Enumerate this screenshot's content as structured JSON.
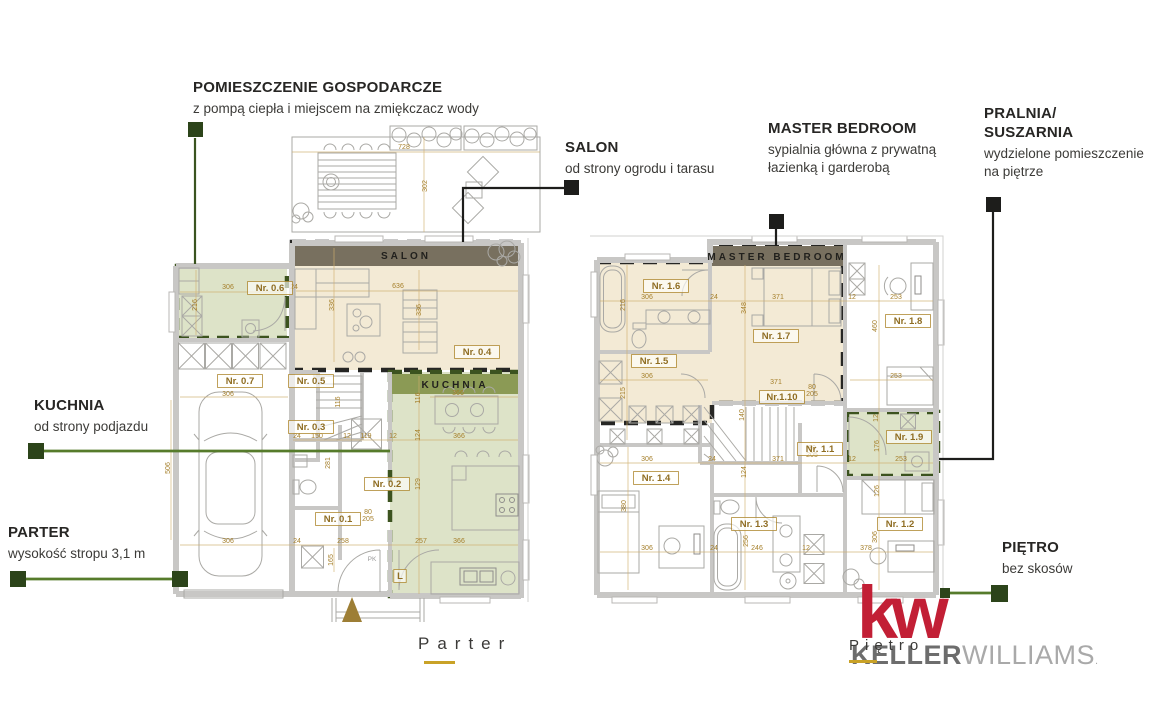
{
  "callouts": {
    "gospodarcze": {
      "title": "POMIESZCZENIE GOSPODARCZE",
      "subtitle": "z pompą ciepła i miejscem na zmiękczacz wody"
    },
    "salon": {
      "title": "SALON",
      "subtitle": "od strony ogrodu i tarasu"
    },
    "master_bedroom": {
      "title": "MASTER BEDROOM",
      "subtitle1": "sypialnia główna z prywatną",
      "subtitle2": "łazienką i garderobą"
    },
    "pralnia": {
      "title1": "PRALNIA/",
      "title2": "SUSZARNIA",
      "subtitle1": "wydzielone pomieszczenie",
      "subtitle2": "na piętrze"
    },
    "kuchnia": {
      "title": "KUCHNIA",
      "subtitle": "od strony podjazdu"
    },
    "parter": {
      "title": "PARTER",
      "subtitle": "wysokość stropu 3,1 m"
    },
    "pietro": {
      "title": "PIĘTRO",
      "subtitle": "bez skosów"
    }
  },
  "plan_ground": {
    "floor_label": "Parter",
    "bands": {
      "salon": "SALON",
      "kuchnia": "KUCHNIA"
    },
    "room_labels": [
      {
        "t": "Nr. 0.6",
        "x": 270,
        "y": 291
      },
      {
        "t": "Nr. 0.4",
        "x": 477,
        "y": 355
      },
      {
        "t": "Nr. 0.7",
        "x": 240,
        "y": 384
      },
      {
        "t": "Nr. 0.5",
        "x": 311,
        "y": 384
      },
      {
        "t": "Nr. 0.3",
        "x": 311,
        "y": 430
      },
      {
        "t": "Nr. 0.2",
        "x": 387,
        "y": 487
      },
      {
        "t": "Nr. 0.1",
        "x": 338,
        "y": 522
      },
      {
        "t": "L",
        "x": 400,
        "y": 579
      }
    ],
    "dims": [
      {
        "t": "728",
        "x": 404,
        "y": 149
      },
      {
        "t": "302",
        "x": 427,
        "y": 186,
        "r": 1
      },
      {
        "t": "306",
        "x": 228,
        "y": 289
      },
      {
        "t": "24",
        "x": 294,
        "y": 289
      },
      {
        "t": "216",
        "x": 197,
        "y": 305,
        "r": 1
      },
      {
        "t": "636",
        "x": 398,
        "y": 288
      },
      {
        "t": "336",
        "x": 334,
        "y": 305,
        "r": 1
      },
      {
        "t": "336",
        "x": 421,
        "y": 310,
        "r": 1
      },
      {
        "t": "116",
        "x": 340,
        "y": 402,
        "r": 1
      },
      {
        "t": "306",
        "x": 228,
        "y": 396
      },
      {
        "t": "506",
        "x": 170,
        "y": 468,
        "r": 1
      },
      {
        "t": "306",
        "x": 228,
        "y": 543
      },
      {
        "t": "24",
        "x": 297,
        "y": 543
      },
      {
        "t": "258",
        "x": 343,
        "y": 543
      },
      {
        "t": "165",
        "x": 333,
        "y": 560,
        "r": 1
      },
      {
        "t": "24",
        "x": 297,
        "y": 438
      },
      {
        "t": "150",
        "x": 317,
        "y": 438
      },
      {
        "t": "12",
        "x": 347,
        "y": 438
      },
      {
        "t": "119",
        "x": 366,
        "y": 438
      },
      {
        "t": "12",
        "x": 393,
        "y": 438
      },
      {
        "t": "116",
        "x": 420,
        "y": 398,
        "r": 1
      },
      {
        "t": "366",
        "x": 458,
        "y": 395
      },
      {
        "t": "124",
        "x": 420,
        "y": 435,
        "r": 1
      },
      {
        "t": "366",
        "x": 459,
        "y": 438
      },
      {
        "t": "129",
        "x": 420,
        "y": 484,
        "r": 1
      },
      {
        "t": "257",
        "x": 421,
        "y": 543
      },
      {
        "t": "366",
        "x": 459,
        "y": 543
      },
      {
        "t": "281",
        "x": 330,
        "y": 463,
        "r": 1
      },
      {
        "t": "80",
        "x": 368,
        "y": 514
      },
      {
        "t": "205",
        "x": 368,
        "y": 521
      }
    ],
    "notes": [
      {
        "t": "PK",
        "x": 372,
        "y": 561
      }
    ]
  },
  "plan_upper": {
    "floor_label": "Piętro",
    "bands": {
      "master": "MASTER BEDROOM"
    },
    "room_labels": [
      {
        "t": "Nr. 1.6",
        "x": 666,
        "y": 289
      },
      {
        "t": "Nr. 1.7",
        "x": 776,
        "y": 339
      },
      {
        "t": "Nr. 1.5",
        "x": 654,
        "y": 364
      },
      {
        "t": "Nr.1.10",
        "x": 782,
        "y": 400
      },
      {
        "t": "Nr. 1.1",
        "x": 820,
        "y": 452
      },
      {
        "t": "Nr. 1.8",
        "x": 908,
        "y": 324
      },
      {
        "t": "Nr. 1.9",
        "x": 909,
        "y": 440
      },
      {
        "t": "Nr. 1.4",
        "x": 656,
        "y": 481
      },
      {
        "t": "Nr. 1.3",
        "x": 754,
        "y": 527
      },
      {
        "t": "Nr. 1.2",
        "x": 900,
        "y": 527
      }
    ],
    "dims": [
      {
        "t": "306",
        "x": 647,
        "y": 299
      },
      {
        "t": "216",
        "x": 625,
        "y": 305,
        "r": 1
      },
      {
        "t": "24",
        "x": 714,
        "y": 299
      },
      {
        "t": "371",
        "x": 778,
        "y": 299
      },
      {
        "t": "348",
        "x": 746,
        "y": 308,
        "r": 1
      },
      {
        "t": "12",
        "x": 852,
        "y": 299
      },
      {
        "t": "253",
        "x": 896,
        "y": 299
      },
      {
        "t": "460",
        "x": 877,
        "y": 326,
        "r": 1
      },
      {
        "t": "306",
        "x": 647,
        "y": 378
      },
      {
        "t": "215",
        "x": 625,
        "y": 393,
        "r": 1
      },
      {
        "t": "253",
        "x": 896,
        "y": 378
      },
      {
        "t": "80",
        "x": 812,
        "y": 389
      },
      {
        "t": "205",
        "x": 812,
        "y": 396
      },
      {
        "t": "371",
        "x": 776,
        "y": 384
      },
      {
        "t": "140",
        "x": 744,
        "y": 415,
        "r": 1
      },
      {
        "t": "371",
        "x": 778,
        "y": 461
      },
      {
        "t": "24",
        "x": 712,
        "y": 461
      },
      {
        "t": "124",
        "x": 746,
        "y": 472,
        "r": 1
      },
      {
        "t": "306",
        "x": 647,
        "y": 461
      },
      {
        "t": "12",
        "x": 852,
        "y": 461
      },
      {
        "t": "253",
        "x": 901,
        "y": 461
      },
      {
        "t": "176",
        "x": 879,
        "y": 446,
        "r": 1
      },
      {
        "t": "12",
        "x": 878,
        "y": 418,
        "r": 1
      },
      {
        "t": "80",
        "x": 812,
        "y": 450
      },
      {
        "t": "205",
        "x": 812,
        "y": 457
      },
      {
        "t": "306",
        "x": 647,
        "y": 550
      },
      {
        "t": "24",
        "x": 714,
        "y": 550
      },
      {
        "t": "380",
        "x": 626,
        "y": 506,
        "r": 1
      },
      {
        "t": "306",
        "x": 877,
        "y": 537,
        "r": 1
      },
      {
        "t": "126",
        "x": 879,
        "y": 491,
        "r": 1
      },
      {
        "t": "378",
        "x": 866,
        "y": 550
      },
      {
        "t": "246",
        "x": 757,
        "y": 550
      },
      {
        "t": "256",
        "x": 748,
        "y": 541,
        "r": 1
      },
      {
        "t": "12",
        "x": 806,
        "y": 550
      }
    ],
    "notes": []
  },
  "logo": {
    "kw": "kw",
    "keller": "KELLER",
    "williams": "WILLIAMS",
    "reg": "."
  },
  "colors": {
    "accent_dark_green": "#2c441a",
    "connector_green": "#567b2b",
    "connector_black": "#1d1d1b",
    "dimension_gold": "#a57f2a",
    "band_taupe": "#78705f",
    "band_green": "#8b9a55",
    "room_green_fill": "#dde3cf",
    "room_beige_fill": "#f1e7cf",
    "kw_red": "#c21f35",
    "underline_gold": "#c9a227"
  }
}
